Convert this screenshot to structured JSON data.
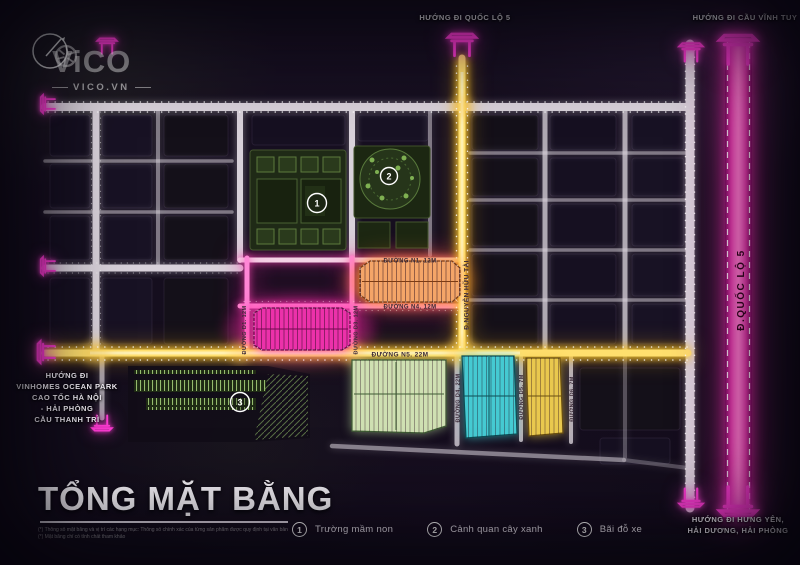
{
  "brand": {
    "name": "ViCO",
    "domain": "VICO.VN"
  },
  "title": {
    "text": "TỔNG MẶT BẰNG"
  },
  "disclaimer": [
    "(*) Thông số mặt bằng và vị trí các hạng mục: Thông số chính xác của từng sản phẩm được quy định tại văn bản ký kết giữa Chủ đầu tư và khách hàng",
    "(*) Mặt bằng chỉ có tính chất tham khảo"
  ],
  "directions": {
    "top_center": "HƯỚNG ĐI QUỐC LỘ 5",
    "top_right": "HƯỚNG ĐI CẦU VĨNH TUY",
    "left_lines": [
      "HƯỚNG ĐI",
      "VINHOMES OCEAN PARK",
      "CAO TỐC HÀ NỘI",
      "- HẢI PHÒNG",
      "CẦU THANH TRÌ"
    ],
    "bottom_right_lines": [
      "HƯỚNG ĐI HƯNG YÊN,",
      "HẢI DƯƠNG, HẢI PHÒNG"
    ]
  },
  "roads": {
    "n1": "ĐƯỜNG N1. 12M",
    "n4": "ĐƯỜNG N4. 12M",
    "n5": "ĐƯỜNG N5. 22M",
    "d1": "ĐƯỜNG D1. 12M",
    "d3": "ĐƯỜNG D3. 12M",
    "d4": "ĐƯỜNG D4. 22M",
    "d5": "ĐƯỜNG D5. 7M",
    "d6": "ĐƯỜNG D6. 7M",
    "nguyen_huu_tai": "Đ.NGUYỄN HỮU TÀI",
    "quoc_lo_5": "Đ.QUỐC LỘ 5"
  },
  "markers": {
    "school": "1",
    "park": "2",
    "parking": "3"
  },
  "legend": [
    {
      "num": "1",
      "label": "Trường mầm non"
    },
    {
      "num": "2",
      "label": "Cảnh quan cây xanh"
    },
    {
      "num": "3",
      "label": "Bãi đỗ xe"
    }
  ],
  "colors": {
    "accent_magenta": "#ff3ad6",
    "road_yellow": "#ffdf6e",
    "road_grey": "#d8d1da",
    "block_orange": "#f4a568",
    "block_magenta": "#ec31aa",
    "block_mint": "#cfe0b2",
    "block_teal": "#45cad2",
    "block_gold": "#e9c84e",
    "highway_pink": "#ff57c4"
  }
}
